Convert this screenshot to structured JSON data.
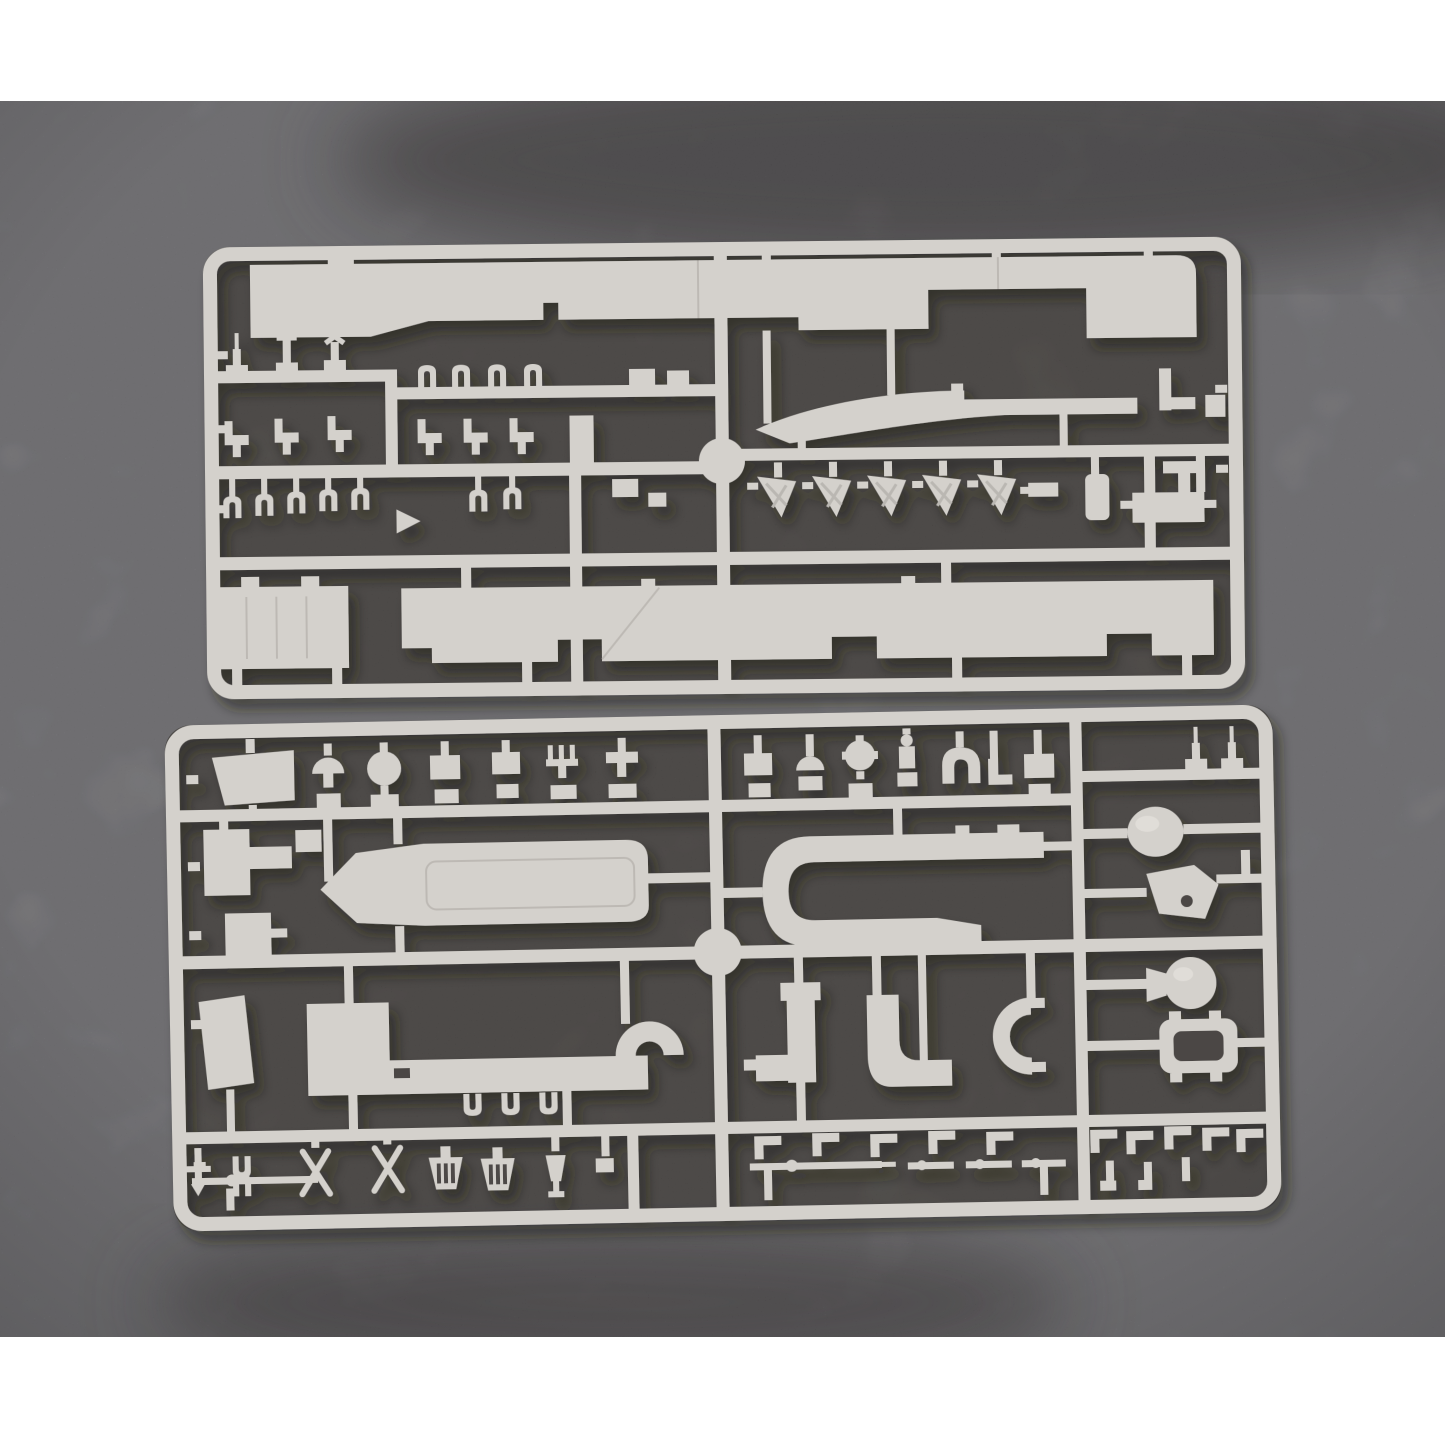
{
  "image": {
    "kind": "product photograph",
    "subject": "Two light-grey injection-molded polystyrene sprues (runner frames) with ship model kit parts, lying on a mottled grey concrete surface",
    "layout": "white bands above and below the photo; upper and lower sprue stacked vertically, both slightly tilted counter-clockwise"
  },
  "palette": {
    "page_bg": "#ffffff",
    "surface": "#8b8a8e",
    "surface_dark": "#575354",
    "interior": "#585451",
    "interior_deep": "#4b4744",
    "plastic": "#d4d1cc",
    "plastic_light": "#e5e2dd",
    "plastic_dark": "#a9a6a1"
  },
  "sprues": [
    {
      "id": "upper",
      "name": "Upper sprue",
      "contents": [
        "long stepped flight-deck strip along the top",
        "three rows of small masts, seats and clips on the left half",
        "row of 5 triangular dart-shaped parts",
        "slender curved hull strake",
        "large rectangular hangar panel lower left",
        "long notched deck strip along the bottom",
        "small fittings column on the right edge",
        "round molding hub on the centre rail"
      ],
      "dart_count": 5,
      "small_part_rows_left": 3
    },
    {
      "id": "lower",
      "name": "Lower sprue",
      "contents": [
        "top row of about 15 small fittings (domes, discs, boxes, davits, arch, figures)",
        "island deck platform with pointed bow end",
        "large U-shaped gallery walkway",
        "spherical radome and pierced bracket on the right",
        "long gallery strip ending in a curled hook",
        "funnel, periscope and horseshoe shaped parts",
        "circular platform with trapezoid flare",
        "rounded rectangular frame with lugs",
        "bottom rows of thin booms, slotted baskets, crossed davit parts",
        "round molding hub on the centre rail"
      ]
    }
  ]
}
